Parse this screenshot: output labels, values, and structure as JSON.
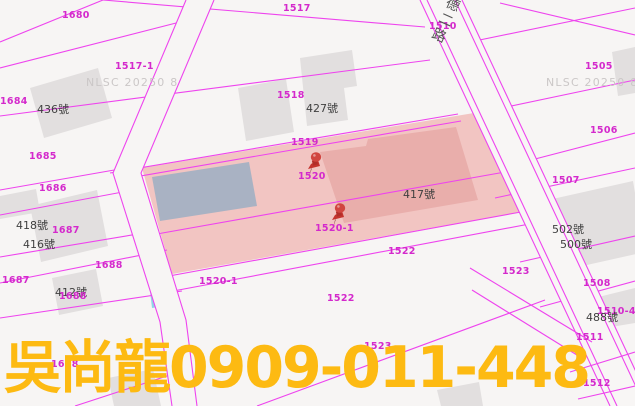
{
  "map": {
    "road_name": "德二路",
    "watermark": "NLSC 20250 8",
    "labels": {
      "p1680": "1680",
      "p1517": "1517",
      "p1517_1": "1517-1",
      "p1684": "1684",
      "h436": "436號",
      "p1518": "1518",
      "h427": "427號",
      "p1685": "1685",
      "p1519": "1519",
      "p1510": "1510",
      "p1520": "1520",
      "p1505": "1505",
      "p1506": "1506",
      "h417": "417號",
      "p1507": "1507",
      "p1686": "1686",
      "h418": "418號",
      "p1687a": "1687",
      "h416": "416號",
      "h502": "502號",
      "h500": "500號",
      "p1688a": "1688",
      "p1523a": "1523",
      "p1687b": "1687",
      "p1508": "1508",
      "h412": "412號",
      "p1688b": "1688",
      "p1520_1a": "1520-1",
      "p1520_1b": "1520-1",
      "p1522a": "1522",
      "p1522b": "1522",
      "h488": "488號",
      "p1510_4": "1510-4",
      "p1511": "1511",
      "p1523b": "1523",
      "p1688c": "1688",
      "p1512": "1512"
    },
    "markers": [
      {
        "name": "pushpin-1520"
      },
      {
        "name": "pushpin-1520-1"
      }
    ],
    "colors": {
      "background": "#f7f5f4",
      "parcel_line": "#ee44ee",
      "parcel_label": "#d429cc",
      "building_gray": "#e2dfdf",
      "highlight_pink": "#f2c5c2",
      "footprint_pink": "#e9aeab",
      "blue_building": "#a9b2c3",
      "cyan_structure": "#8ed6e6",
      "pin_red": "#c4332e",
      "ad_yellow": "#fdba12"
    }
  },
  "overlay": {
    "contact": "吳尚龍0909-011-448"
  }
}
